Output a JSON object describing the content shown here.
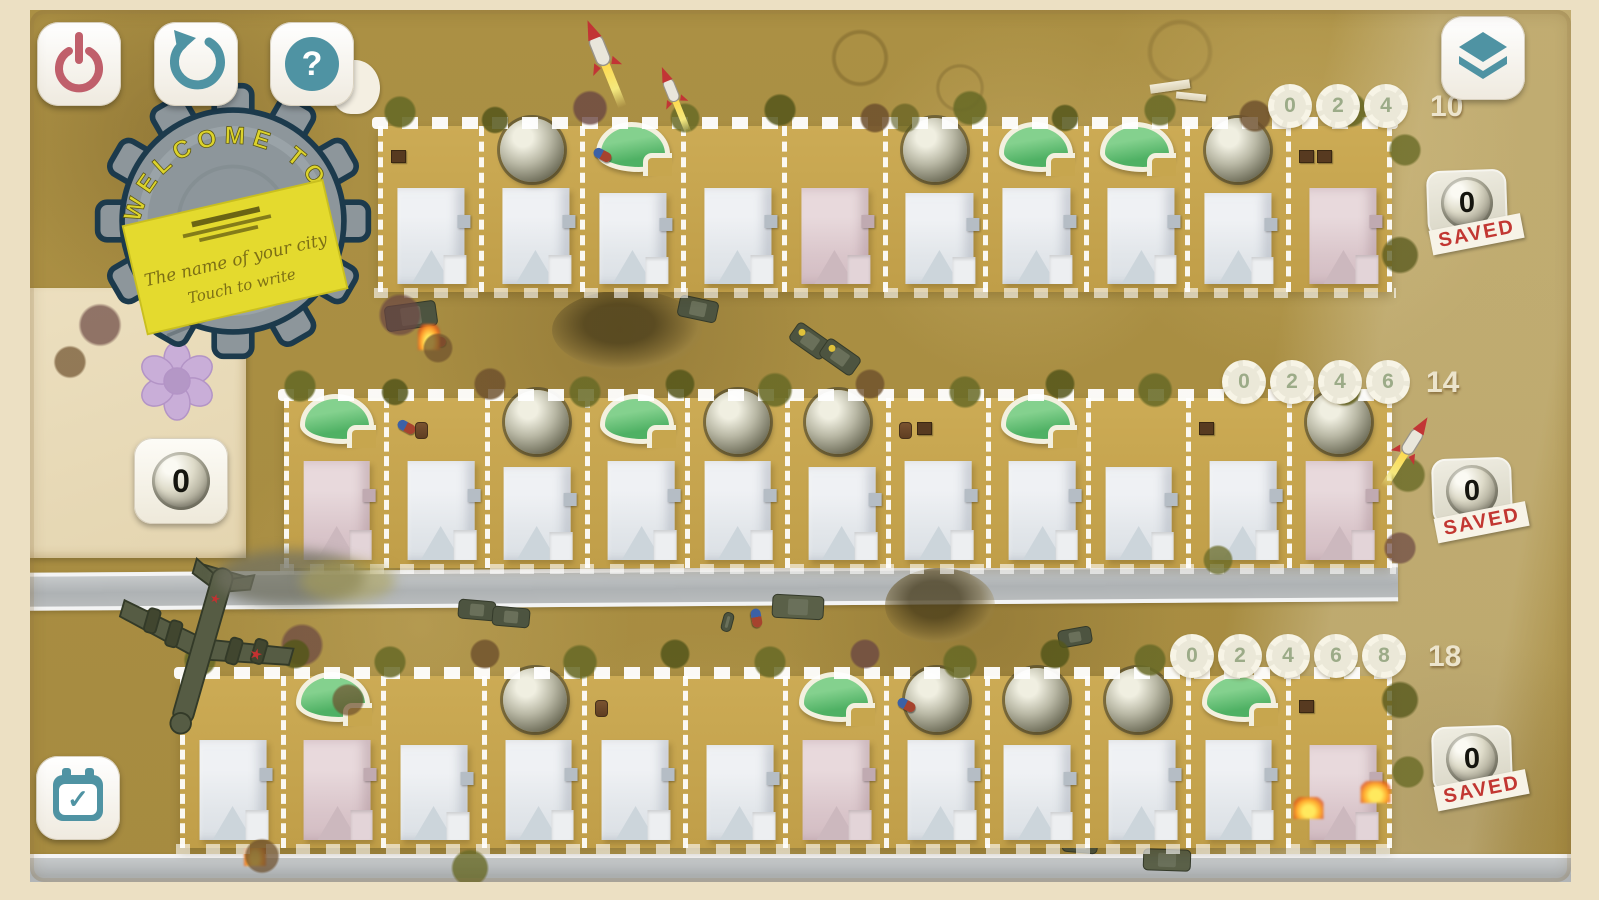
{
  "logo": {
    "arc_text": "WELCOME TO",
    "sign_line1": "The name of your city",
    "sign_line2": "Touch to write"
  },
  "icons": {
    "power": "power-icon",
    "restart": "restart-icon",
    "help": "question-icon",
    "help_glyph": "?",
    "layers": "layers-icon",
    "confirm": "calendar-check-icon",
    "confirm_glyph": "✓",
    "flower": "flower-icon"
  },
  "side": {
    "plan_count": "0"
  },
  "saved_label": "SAVED",
  "streets": [
    {
      "park_scores": [
        "0",
        "2",
        "4"
      ],
      "max_score": "10",
      "saved": "0",
      "lots": [
        {
          "house": "white",
          "decoration": "none",
          "items": [
            "box"
          ]
        },
        {
          "house": "white",
          "decoration": "dome",
          "items": []
        },
        {
          "house": "white",
          "decoration": "pool",
          "items": [
            "soldier"
          ]
        },
        {
          "house": "white",
          "decoration": "none",
          "items": []
        },
        {
          "house": "pink",
          "decoration": "none",
          "items": []
        },
        {
          "house": "white",
          "decoration": "dome",
          "items": []
        },
        {
          "house": "white",
          "decoration": "pool",
          "items": []
        },
        {
          "house": "white",
          "decoration": "pool",
          "items": []
        },
        {
          "house": "white",
          "decoration": "dome",
          "items": []
        },
        {
          "house": "pink",
          "decoration": "none",
          "items": [
            "box",
            "box"
          ]
        }
      ]
    },
    {
      "park_scores": [
        "0",
        "2",
        "4",
        "6"
      ],
      "max_score": "14",
      "saved": "0",
      "lots": [
        {
          "house": "pink",
          "decoration": "pool",
          "items": []
        },
        {
          "house": "white",
          "decoration": "none",
          "items": [
            "soldier",
            "barrel"
          ]
        },
        {
          "house": "white",
          "decoration": "dome",
          "items": []
        },
        {
          "house": "white",
          "decoration": "pool",
          "items": []
        },
        {
          "house": "white",
          "decoration": "dome",
          "items": []
        },
        {
          "house": "white",
          "decoration": "dome",
          "items": []
        },
        {
          "house": "white",
          "decoration": "none",
          "items": [
            "barrel",
            "box"
          ]
        },
        {
          "house": "white",
          "decoration": "pool",
          "items": []
        },
        {
          "house": "white",
          "decoration": "none",
          "items": []
        },
        {
          "house": "white",
          "decoration": "none",
          "items": [
            "box"
          ]
        },
        {
          "house": "pink",
          "decoration": "dome",
          "items": []
        }
      ]
    },
    {
      "park_scores": [
        "0",
        "2",
        "4",
        "6",
        "8"
      ],
      "max_score": "18",
      "saved": "0",
      "lots": [
        {
          "house": "white",
          "decoration": "none",
          "items": []
        },
        {
          "house": "pink",
          "decoration": "pool",
          "items": []
        },
        {
          "house": "white",
          "decoration": "none",
          "items": []
        },
        {
          "house": "white",
          "decoration": "dome",
          "items": []
        },
        {
          "house": "white",
          "decoration": "none",
          "items": [
            "barrel"
          ]
        },
        {
          "house": "white",
          "decoration": "none",
          "items": []
        },
        {
          "house": "pink",
          "decoration": "pool",
          "items": []
        },
        {
          "house": "white",
          "decoration": "dome",
          "items": [
            "soldier"
          ]
        },
        {
          "house": "white",
          "decoration": "dome",
          "items": []
        },
        {
          "house": "white",
          "decoration": "dome",
          "items": []
        },
        {
          "house": "white",
          "decoration": "pool",
          "items": []
        },
        {
          "house": "pink",
          "decoration": "none",
          "burning": true,
          "items": [
            "box"
          ]
        }
      ]
    }
  ],
  "colors": {
    "accent_teal": "#4f93a3",
    "accent_red": "#c05f6b",
    "stamp_red": "#c23732",
    "pool_green": "#54b567",
    "badge_number": "#9cab88",
    "desert": "#ab9044",
    "lot_tan": "#c9a64d",
    "frame_cream": "#ece0c3",
    "sign_yellow": "#e4da2e"
  }
}
